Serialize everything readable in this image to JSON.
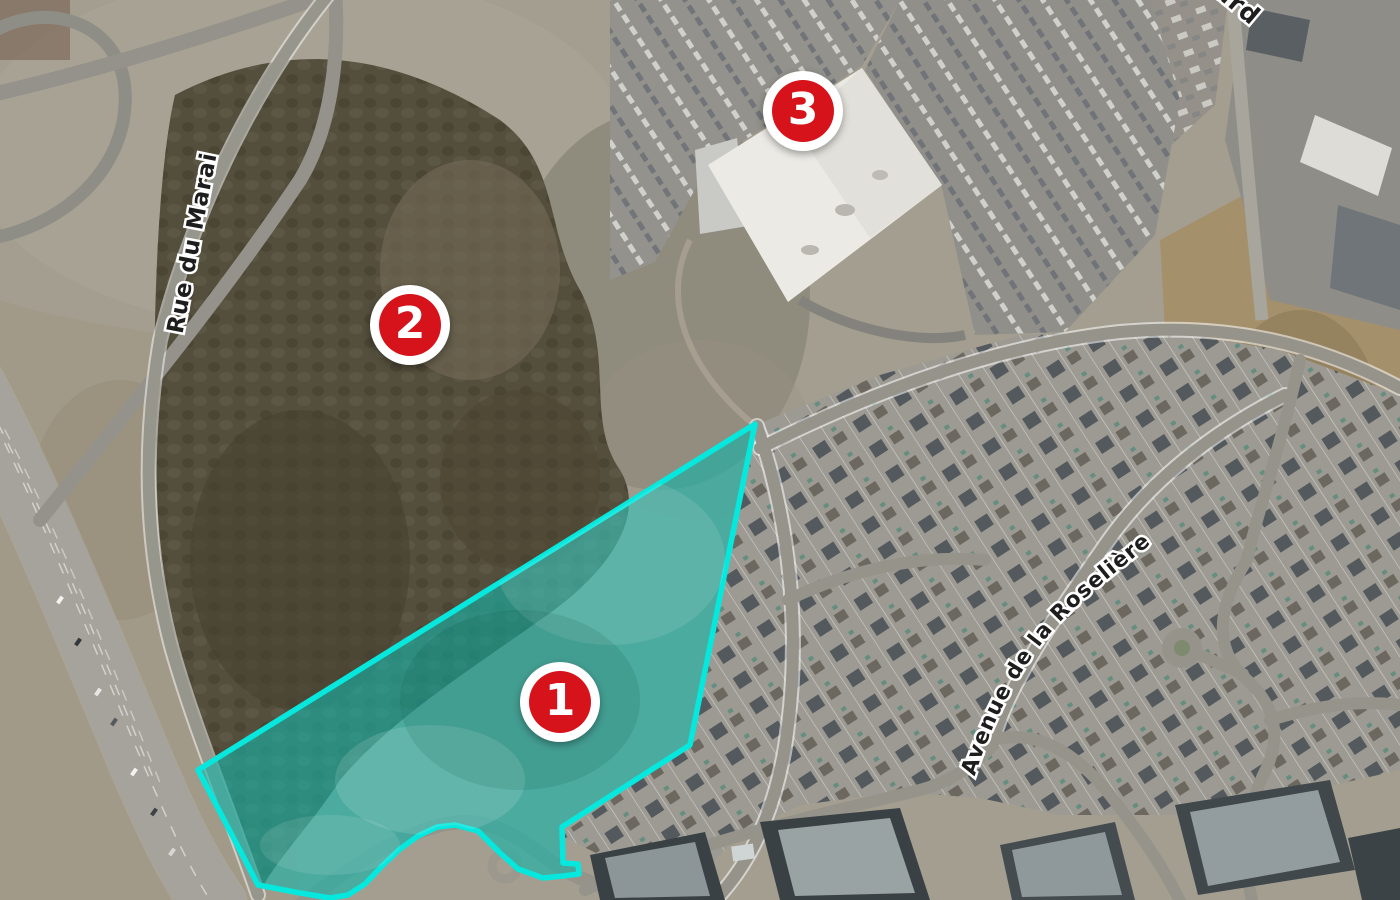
{
  "map": {
    "description": "Aerial satellite view with highlighted land parcel and three numbered location markers",
    "markers": [
      {
        "label": "1"
      },
      {
        "label": "2"
      },
      {
        "label": "3"
      }
    ],
    "street_labels": {
      "rue_du_marais": "Rue du Marais",
      "avenue_roseliere": "Avenue de la Roselière",
      "partial_top_right": "ard"
    },
    "colors": {
      "marker_red": "#d6121b",
      "marker_ring": "#ffffff",
      "parcel_outline": "#06e8de",
      "parcel_fill": "#17b3a8"
    }
  }
}
